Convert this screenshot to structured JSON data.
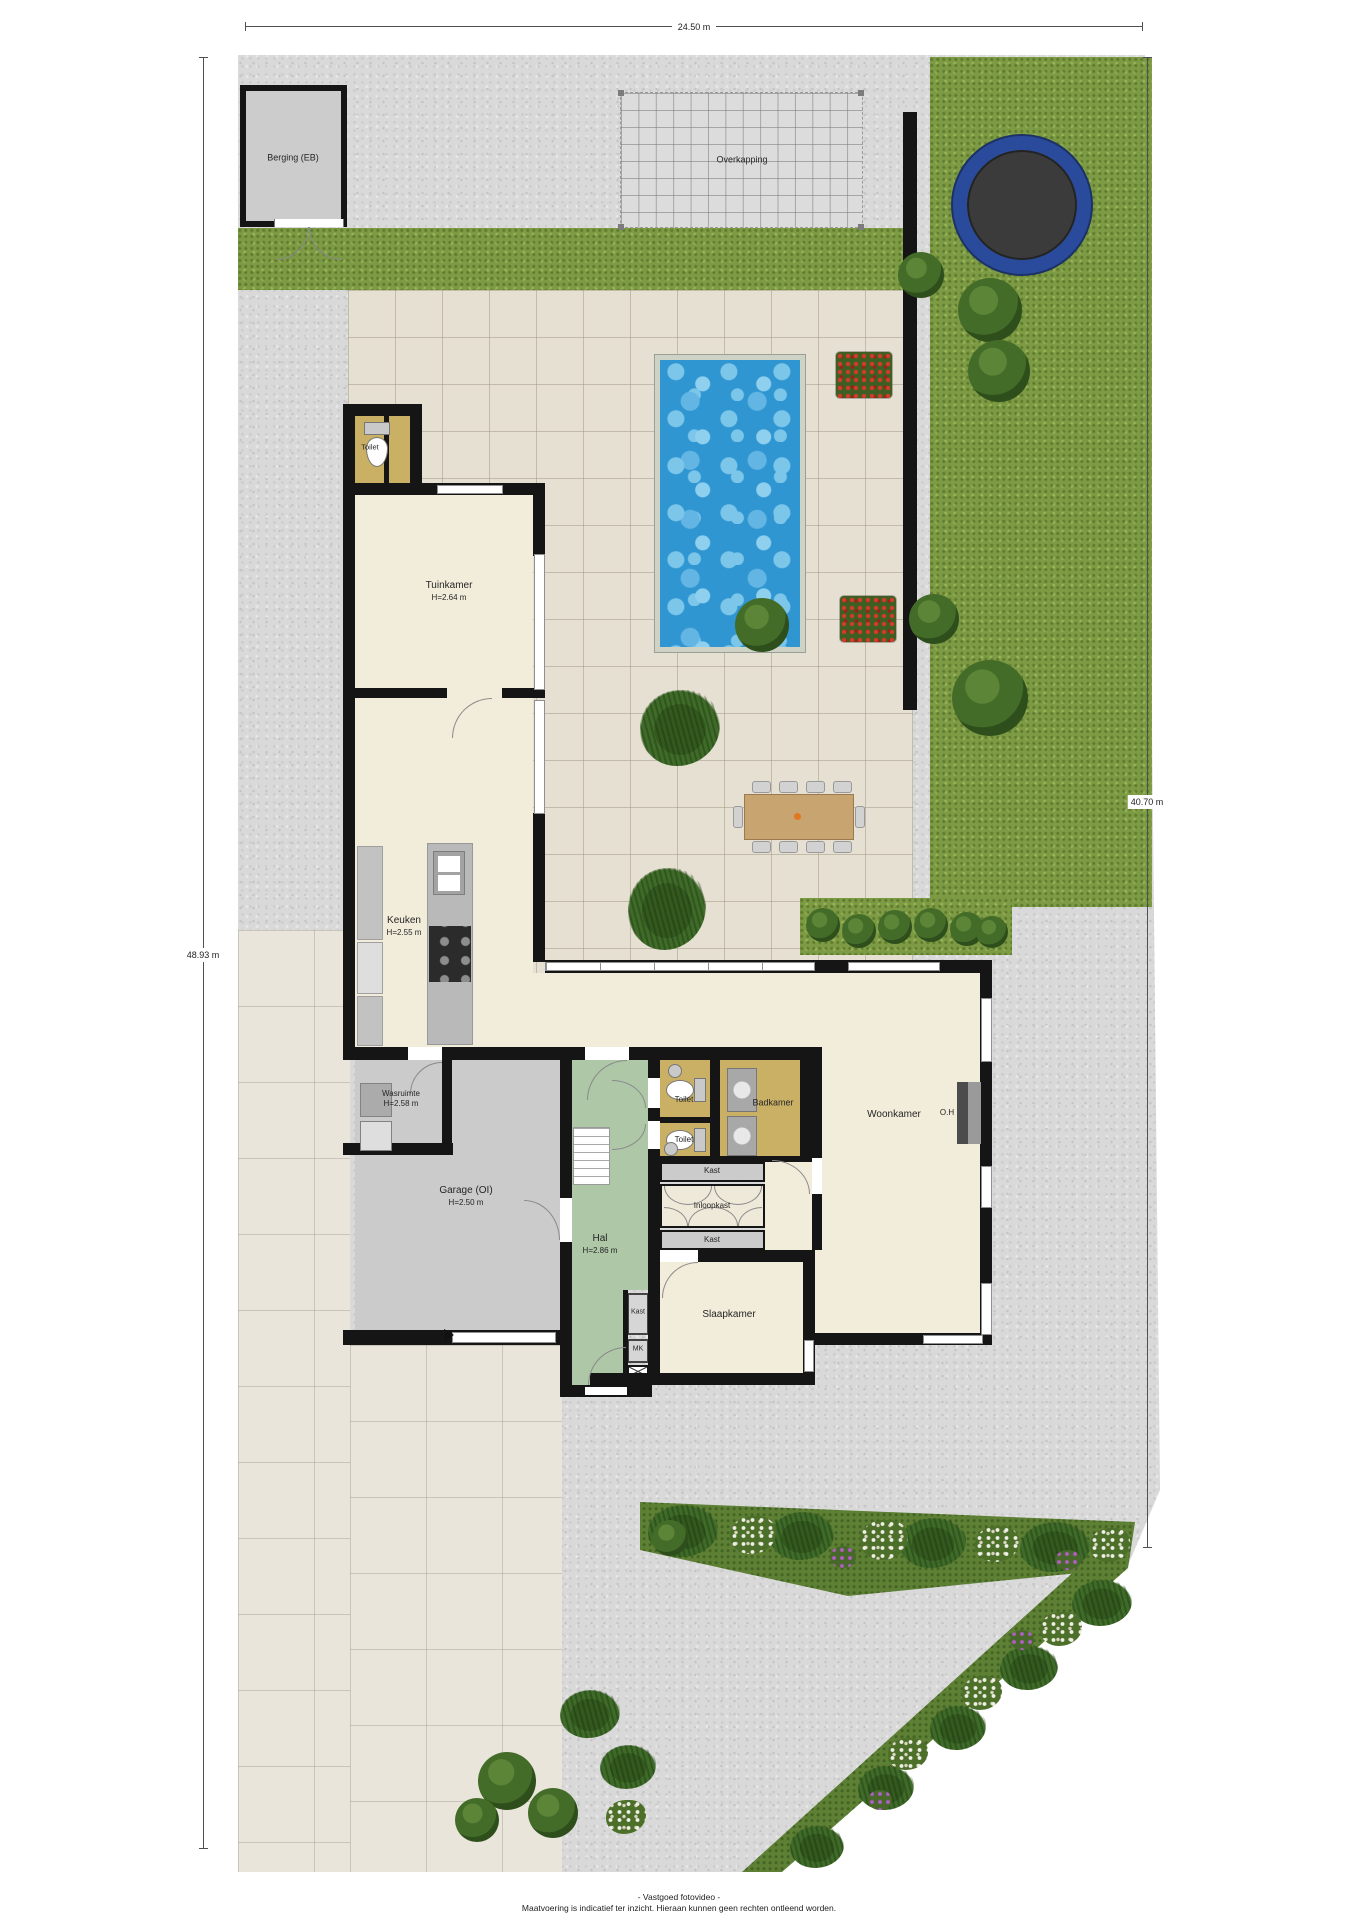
{
  "plan": {
    "dimensions": {
      "width_top": "24.50 m",
      "height_left": "48.93 m",
      "height_right": "40.70 m"
    },
    "rooms": {
      "berging": {
        "label": "Berging (EB)"
      },
      "overkapping": {
        "label": "Overkapping"
      },
      "toilet_tuinkamer": {
        "label": "Toilet"
      },
      "tuinkamer": {
        "label": "Tuinkamer",
        "height": "H=2.64 m"
      },
      "keuken": {
        "label": "Keuken",
        "height": "H=2.55 m"
      },
      "wasruimte": {
        "label": "Wasruimte",
        "height": "H=2.58 m"
      },
      "garage": {
        "label": "Garage (OI)",
        "height": "H=2.50 m"
      },
      "hal": {
        "label": "Hal",
        "height": "H=2.86 m"
      },
      "toilet_1": {
        "label": "Toilet"
      },
      "toilet_2": {
        "label": "Toilet"
      },
      "badkamer": {
        "label": "Badkamer"
      },
      "kast_badkamer": {
        "label": "Kast"
      },
      "inloopkast": {
        "label": "Inloopkast"
      },
      "kast_slaapkamer": {
        "label": "Kast"
      },
      "slaapkamer": {
        "label": "Slaapkamer"
      },
      "woonkamer": {
        "label": "Woonkamer"
      },
      "fireplace": {
        "label": "O.H"
      },
      "kast_hal": {
        "label": "Kast"
      },
      "meterkast": {
        "label": "MK"
      }
    },
    "footer": {
      "line1": "- Vastgoed fotovideo -",
      "line2": "Maatvoering is indicatief ter inzicht. Hieraan kunnen geen rechten ontleend worden."
    },
    "colors": {
      "wall": "#151515",
      "grass": "#7d9b44",
      "pool_water": "#2f96d2",
      "gravel": "#d9d9d9",
      "terrace_tiles": "#e5e0d2",
      "room_cream": "#f2ecdb",
      "room_khaki": "#c9b065",
      "hall_green": "#adc7a7",
      "garage_gray": "#cbcbcb",
      "trampoline_ring": "#2a4b9b"
    }
  }
}
